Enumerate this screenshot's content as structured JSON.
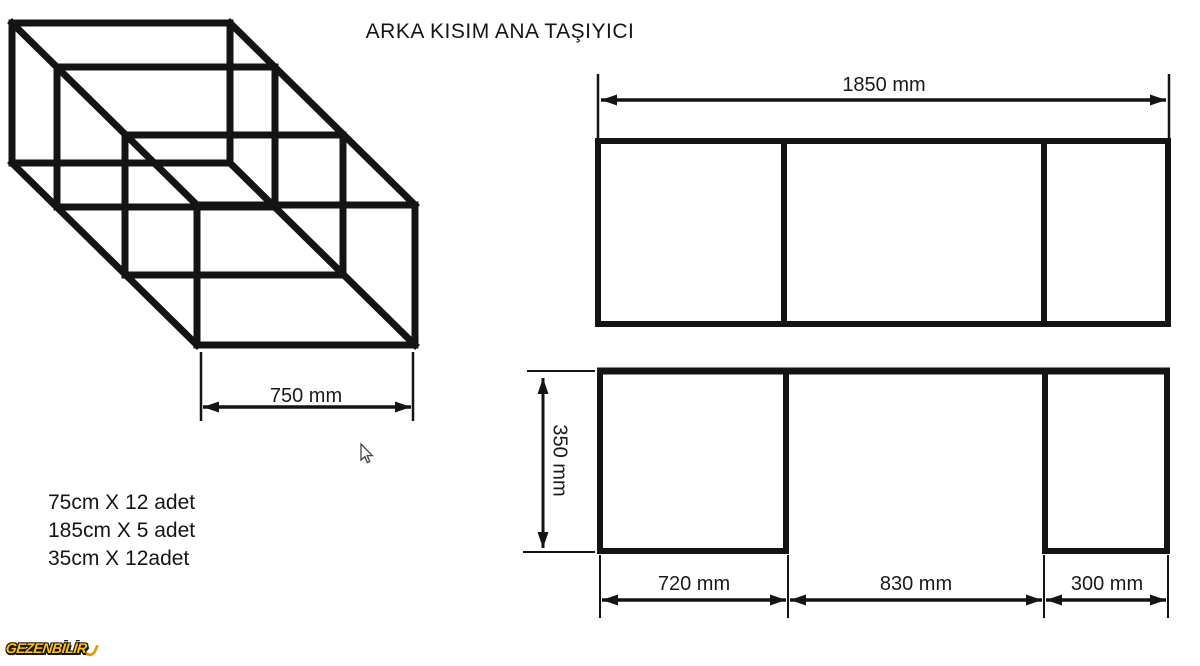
{
  "title": "ARKA KISIM ANA TAŞIYICI",
  "isometric_view": {
    "depth_dimension": "750 mm"
  },
  "materials_list": {
    "items": [
      "75cm X 12 adet",
      "185cm X 5 adet",
      "35cm X 12adet"
    ]
  },
  "top_view": {
    "width_dimension": "1850 mm"
  },
  "front_view": {
    "height_dimension": "350 mm",
    "section_dimensions": [
      "720 mm",
      "830 mm",
      "300 mm"
    ]
  },
  "watermark": "GEZENBİLİR",
  "colors": {
    "line": "#141414",
    "background": "#ffffff",
    "logo_yellow": "#ffc20e",
    "logo_outline": "#151515"
  }
}
